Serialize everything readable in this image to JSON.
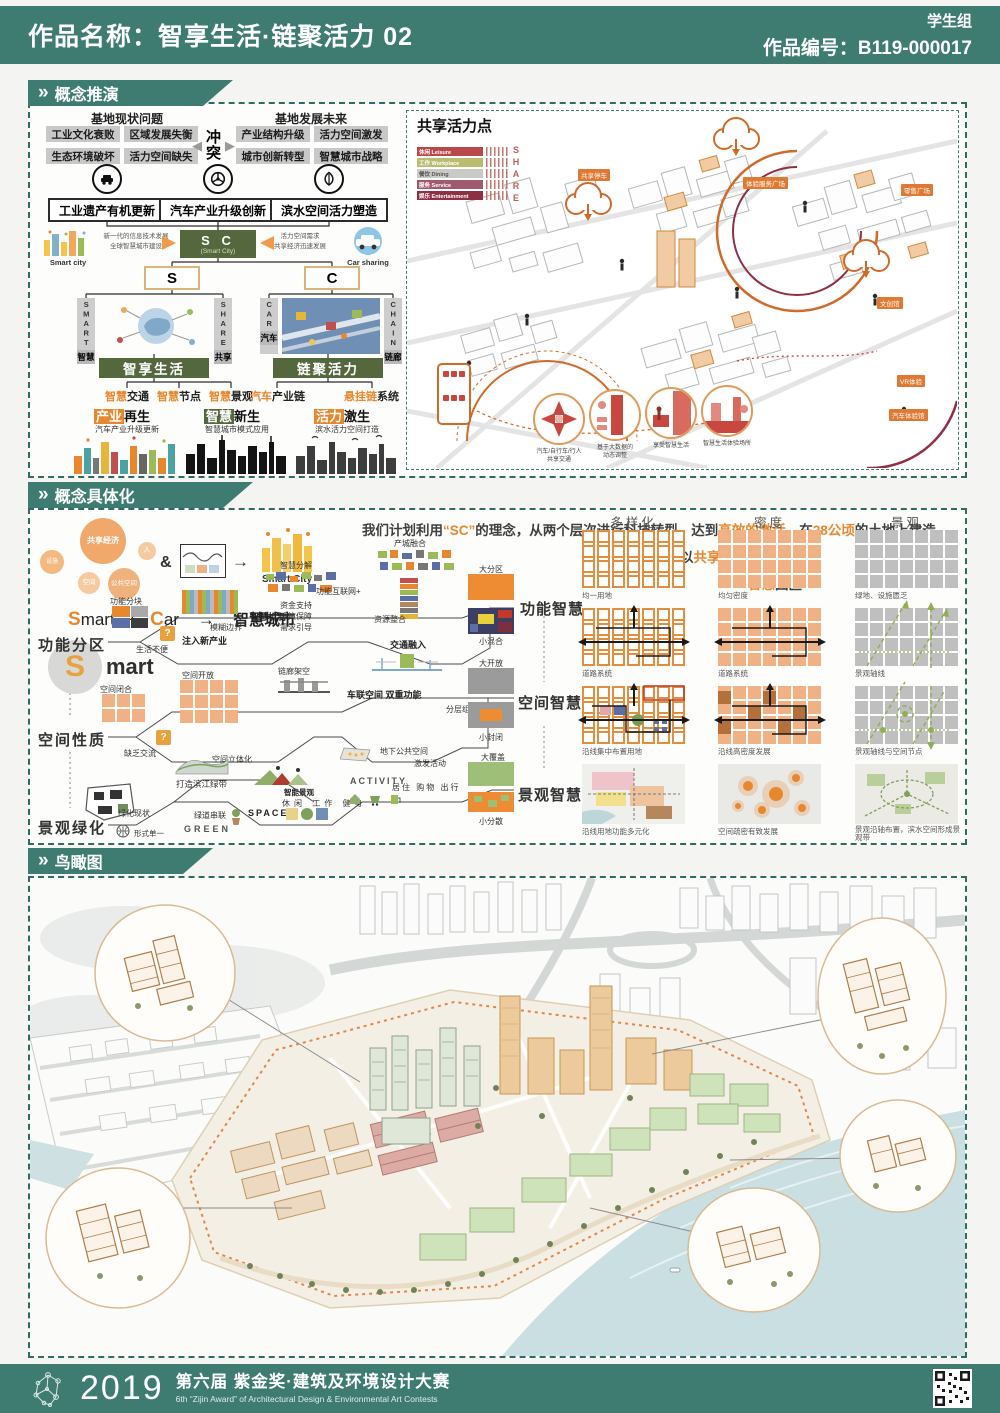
{
  "chev": "»",
  "header": {
    "title": "作品名称：智享生活·链聚活力 02",
    "group": "学生组",
    "code": "作品编号：B119-000017"
  },
  "s1": {
    "banner": "概念推演",
    "left": {
      "problem_title": "基地现状问题",
      "problems": [
        "工业文化衰败",
        "区域发展失衡",
        "生态环境破坏",
        "活力空间缺失"
      ],
      "conflict": "冲突",
      "future_title": "基地发展未来",
      "futures": [
        "产业结构升级",
        "活力空间激发",
        "城市创新转型",
        "智慧城市战略"
      ],
      "strategies": [
        "工业遗产有机更新",
        "汽车产业升级创新",
        "滨水空间活力塑造"
      ],
      "sc_main": "S C",
      "sc_sub": "(Smart City)",
      "sc_left_note": "新一代的信息技术发展\n全球智慧城市建设",
      "sc_left_caption": "Smart city",
      "sc_right_note": "活力空间需求\n共享经济迅速发展",
      "sc_right_caption": "Car sharing",
      "s_box": "S",
      "c_box": "C",
      "pillars": [
        {
          "en": "SMART",
          "cn": "智慧"
        },
        {
          "en": "SHARE",
          "cn": "共享"
        },
        {
          "en": "CAR",
          "cn": "汽车"
        },
        {
          "en": "CHAIN",
          "cn": "链廊"
        }
      ],
      "theme_left": "智享生活",
      "theme_right": "链聚活力",
      "smart_items": [
        {
          "hl": "智慧",
          "rest": "交通"
        },
        {
          "hl": "智慧",
          "rest": "节点"
        },
        {
          "hl": "智慧",
          "rest": "景观"
        }
      ],
      "chain_items": [
        {
          "hl": "汽车",
          "rest": "产业链"
        },
        {
          "hl": "悬挂链",
          "rest": "系统"
        }
      ],
      "outcomes": [
        {
          "hl": "产业",
          "rest": "再生",
          "sub": "汽车产业升级更新"
        },
        {
          "hl": "智慧",
          "rest": "新生",
          "sub": "智慧城市模式应用"
        },
        {
          "hl": "活力",
          "rest": "激生",
          "sub": "滨水活力空间打造"
        }
      ]
    },
    "right": {
      "title": "共享活力点",
      "legend": [
        {
          "label": "休闲  Leisure",
          "color": "#b8494a"
        },
        {
          "label": "工作  Workplace",
          "color": "#b9bd6d"
        },
        {
          "label": "餐饮  Dining",
          "color": "#c9c9c5"
        },
        {
          "label": "服务  Service",
          "color": "#a05a70"
        },
        {
          "label": "娱乐  Entertainment",
          "color": "#8e3044"
        }
      ],
      "legend_side": "SHARE",
      "tags": [
        "共享停车",
        "体验服务广场",
        "零售广场",
        "文创馆",
        "VR体验",
        "汽车体验馆"
      ],
      "circles": [
        "汽车/自行车/行人\n共享交通",
        "基于大数据的\n动态调整",
        "享受智慧生活",
        "智慧生活体验场所"
      ]
    }
  },
  "s2": {
    "banner": "概念具体化",
    "intro": {
      "a": "我们计划利用",
      "b": "“SC”",
      "c": "的理念，从两个层次进行科技转型，达到",
      "d": "高效的激活",
      "e": "，在",
      "f": "28公顷",
      "g": "的土地上建造",
      "h": "以",
      "i": "共享汽车",
      "j": "为主题的",
      "k": "智慧",
      "l": "园区"
    },
    "bubbles": [
      "共享经济",
      "人",
      "设施",
      "空间",
      "公共空间"
    ],
    "amp": "&",
    "smart_city_caption": "Smart City",
    "formula": {
      "s": "S",
      "mart": "mart",
      "plus": "+",
      "c": "C",
      "ar": "ar",
      "arrow": "→",
      "result": "智慧城市"
    },
    "big_s": "S",
    "big_rest": "mart",
    "rows": [
      "功能分区",
      "空间性质",
      "景观绿化"
    ],
    "results": [
      "功能智慧",
      "空间智慧",
      "景观智慧"
    ],
    "f1": {
      "a": "功能分块",
      "b": "生活不便",
      "c": "注入新产业",
      "d": "模糊边界",
      "e": "智慧机制",
      "f": "资金支持",
      "g": "政策保障",
      "h": "需求引导",
      "i": "智慧分解",
      "j": "产城融合",
      "k": "功能互联网+",
      "l": "资源整合",
      "q": "?",
      "r1": "大分区",
      "r2": "小混合"
    },
    "f2": {
      "a": "空间闭合",
      "b": "缺乏交流",
      "c": "空间开放",
      "d": "链廊架空",
      "e": "分层组织",
      "f": "地下公共空间",
      "g": "交通融入",
      "h": "车联空间 双重功能",
      "i": "空间立体化",
      "q": "?",
      "r1": "大开放",
      "r2": "小封闭"
    },
    "f3": {
      "a": "绿化现状",
      "b": "形式单一",
      "c": "打造滨江绿带",
      "d": "绿道串联",
      "e": "GREEN",
      "f": "SPACE",
      "g": "休闲",
      "h": "工作",
      "i": "健身",
      "j": "智能景观",
      "k": "激发活动",
      "l": "ACTIVITY",
      "m": "居住",
      "n": "购物",
      "o": "出行",
      "r1": "大覆盖",
      "r2": "小分散"
    },
    "matrix": {
      "headers": [
        "多样化",
        "密度",
        "景观"
      ],
      "captions": [
        [
          "均一用地",
          "均匀密度",
          "绿地、设施匮乏"
        ],
        [
          "道路系统",
          "道路系统",
          "景观轴线"
        ],
        [
          "沿线集中布置用地",
          "沿线高密度发展",
          "景观轴线与空间节点"
        ],
        [
          "沿线用地功能多元化",
          "空间疏密有致发展",
          "景观沿轴布置，滨水空间形成景观带"
        ]
      ]
    }
  },
  "s3": {
    "banner": "鸟瞰图"
  },
  "footer": {
    "year": "2019",
    "title": "第六届 紫金奖·建筑及环境设计大赛",
    "subtitle": "6th “Zijin Award” of Architectural Design & Environmental Art Contests"
  }
}
